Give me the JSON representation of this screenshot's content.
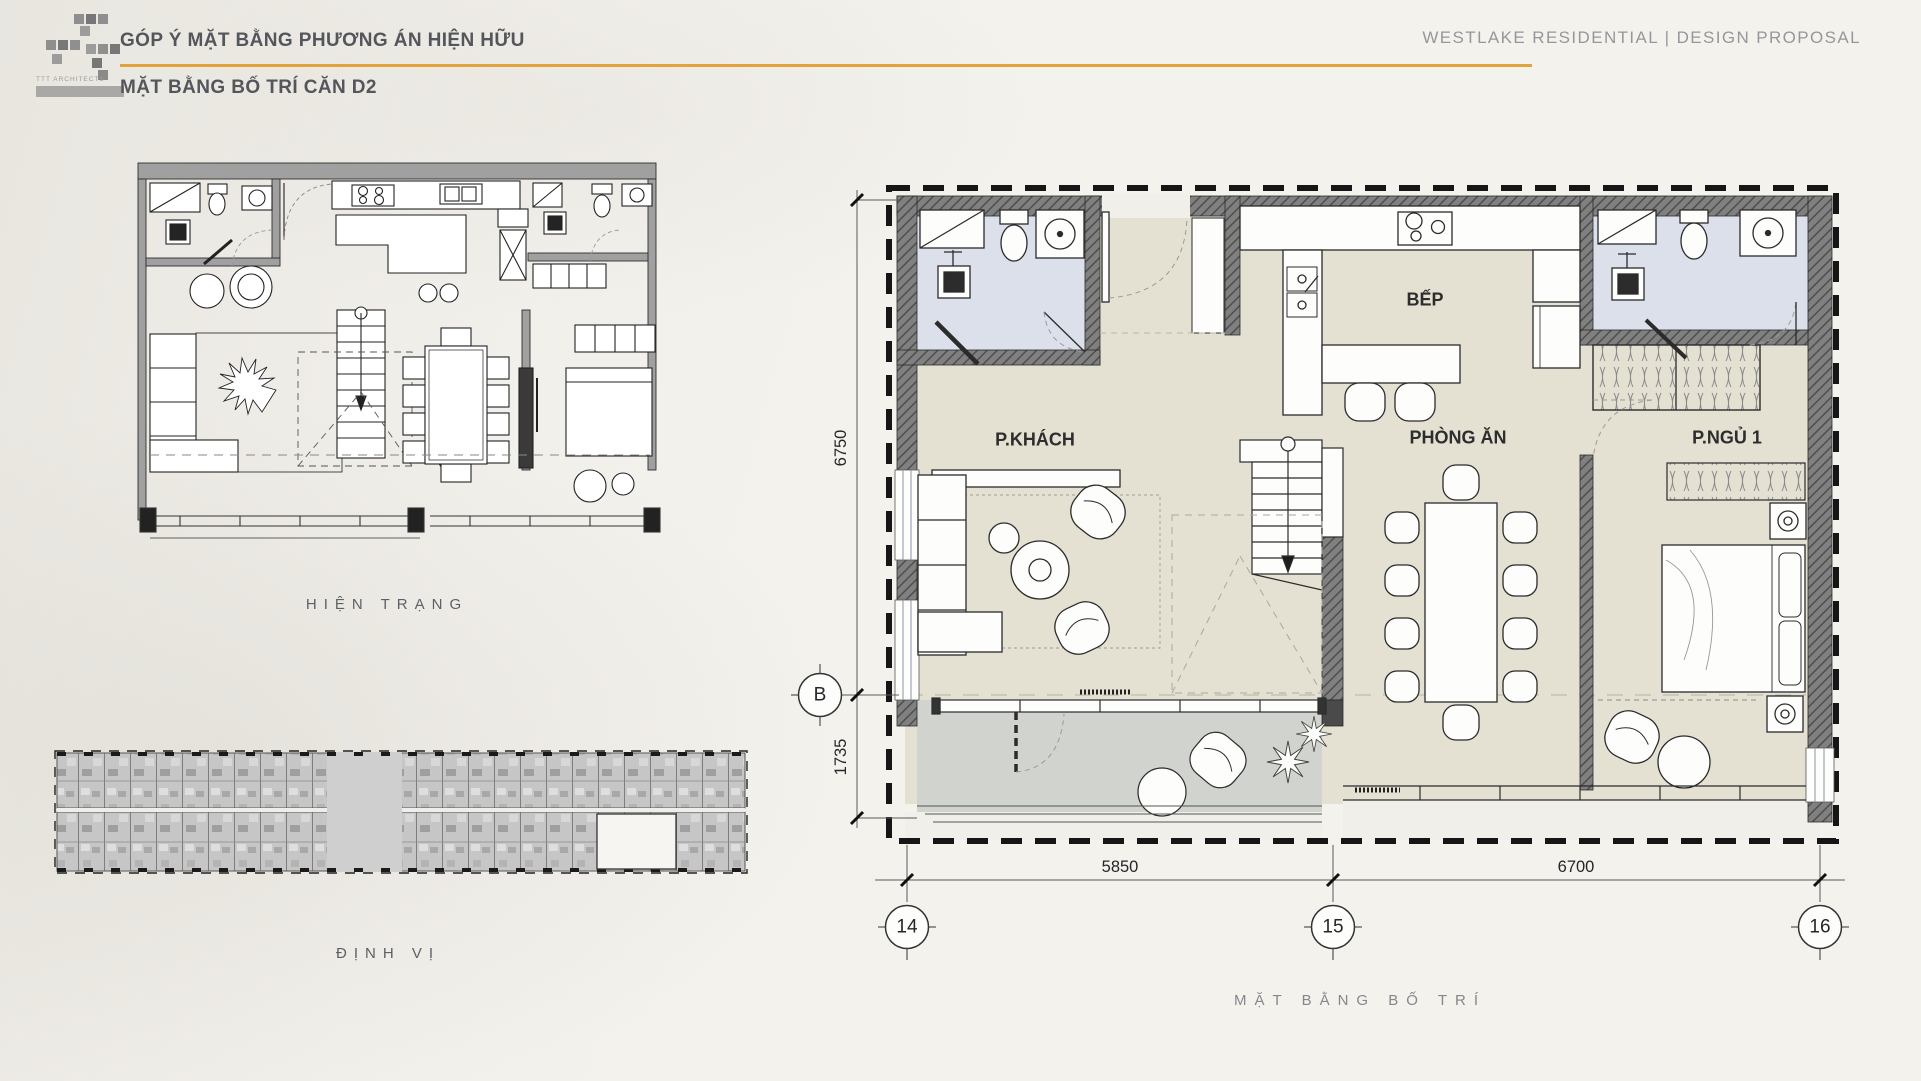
{
  "header": {
    "brand": "TTT ARCHITECTS",
    "title": "GÓP Ý MẶT BẰNG PHƯƠNG ÁN HIỆN HỮU",
    "subtitle": "MẶT BẰNG BỐ TRÍ CĂN D2",
    "project": "WESTLAKE RESIDENTIAL | DESIGN PROPOSAL"
  },
  "captions": {
    "existing": "HIỆN TRẠNG",
    "locator": "ĐỊNH VỊ",
    "layout": "MẶT BẰNG BỐ TRÍ"
  },
  "rooms": {
    "living": "P.KHÁCH",
    "kitchen": "BẾP",
    "dining": "PHÒNG ĂN",
    "bedroom": "P.NGỦ 1"
  },
  "dimensions": {
    "left_upper": "6750",
    "left_lower": "1735",
    "bottom_left": "5850",
    "bottom_right": "6700"
  },
  "grid": {
    "row_b": "B",
    "col_14": "14",
    "col_15": "15",
    "col_16": "16"
  },
  "colors": {
    "accent": "#E2A23C",
    "wall_hatch": "#7B7B7B",
    "floor_beige": "#E4E1D3",
    "floor_bath": "#DCE0EA",
    "floor_balcony": "#D0D3CE",
    "keyplan_gray": "#C6C6C6"
  }
}
